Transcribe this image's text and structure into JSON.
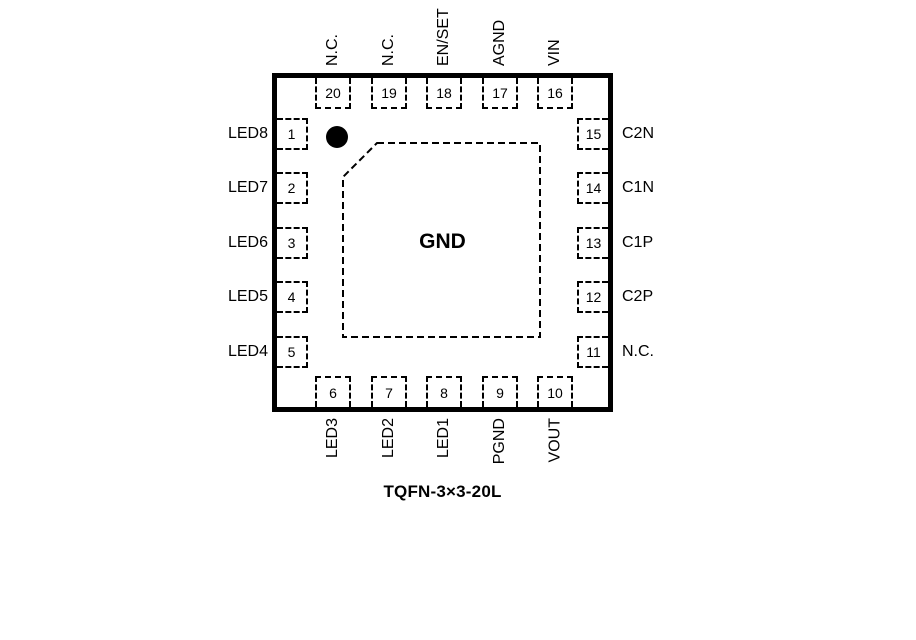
{
  "caption": "TQFN-3×3-20L",
  "chip": {
    "center_pad": "GND",
    "pin1_marker_icon": "filled-circle",
    "pins": {
      "top": [
        {
          "num": "20",
          "label": "N.C."
        },
        {
          "num": "19",
          "label": "N.C."
        },
        {
          "num": "18",
          "label": "EN/SET"
        },
        {
          "num": "17",
          "label": "AGND"
        },
        {
          "num": "16",
          "label": "VIN"
        }
      ],
      "left": [
        {
          "num": "1",
          "label": "LED8"
        },
        {
          "num": "2",
          "label": "LED7"
        },
        {
          "num": "3",
          "label": "LED6"
        },
        {
          "num": "4",
          "label": "LED5"
        },
        {
          "num": "5",
          "label": "LED4"
        }
      ],
      "right": [
        {
          "num": "15",
          "label": "C2N"
        },
        {
          "num": "14",
          "label": "C1N"
        },
        {
          "num": "13",
          "label": "C1P"
        },
        {
          "num": "12",
          "label": "C2P"
        },
        {
          "num": "11",
          "label": "N.C."
        }
      ],
      "bottom": [
        {
          "num": "6",
          "label": "LED3"
        },
        {
          "num": "7",
          "label": "LED2"
        },
        {
          "num": "8",
          "label": "LED1"
        },
        {
          "num": "9",
          "label": "PGND"
        },
        {
          "num": "10",
          "label": "VOUT"
        }
      ]
    }
  },
  "colors": {
    "line": "#000000",
    "background": "#ffffff"
  }
}
